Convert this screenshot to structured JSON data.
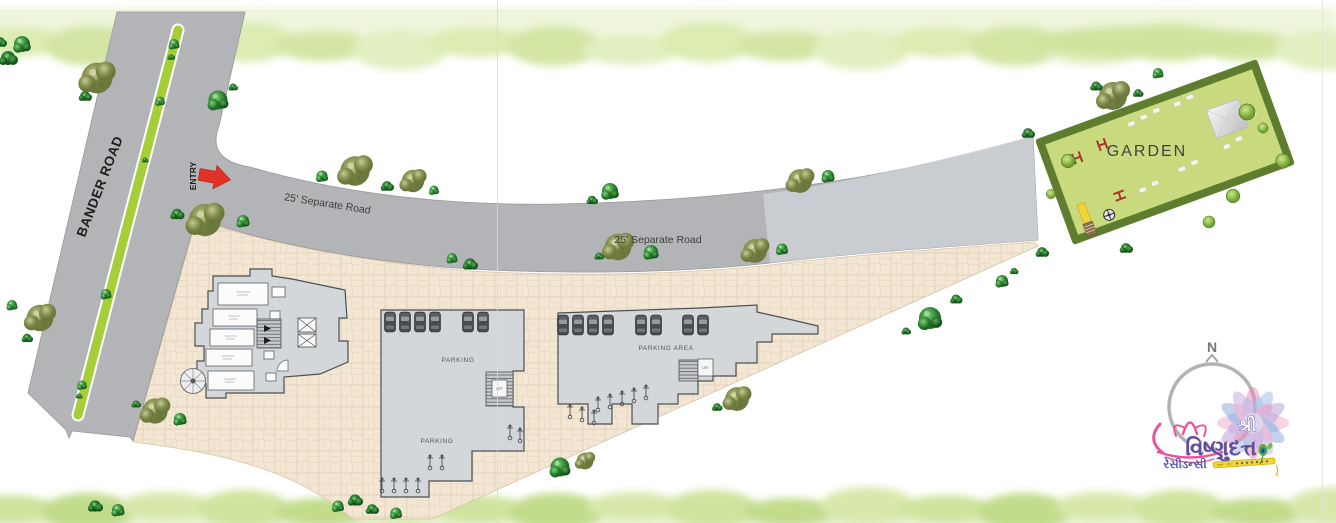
{
  "site": {
    "roads": {
      "bander": "BANDER ROAD",
      "entry": "ENTRY",
      "separate1": "25' Separate Road",
      "separate2": "25' Separate Road"
    },
    "garden": {
      "label": "GARDEN"
    },
    "buildings": {
      "b": {
        "parking_upper": "PARKING",
        "parking_lower": "PARKING",
        "lift": "LIFT"
      },
      "c": {
        "parking_area": "PARKING AREA",
        "lift": "LIFT"
      }
    },
    "compass": {
      "north": "N"
    },
    "logo": {
      "prefix": "શ્રી",
      "name": "વિષ્ણુદત્ત",
      "subtitle": "રેસીડન્સી"
    },
    "colors": {
      "road_gray": "#b5b7b9",
      "plot_beige": "#f3e7d4",
      "garden_green": "#cbdc7e",
      "hedge_green": "#5e7d2e",
      "entry_red": "#e03226",
      "logo_blue": "#4f55a0",
      "logo_pink": "#e8559b"
    }
  }
}
